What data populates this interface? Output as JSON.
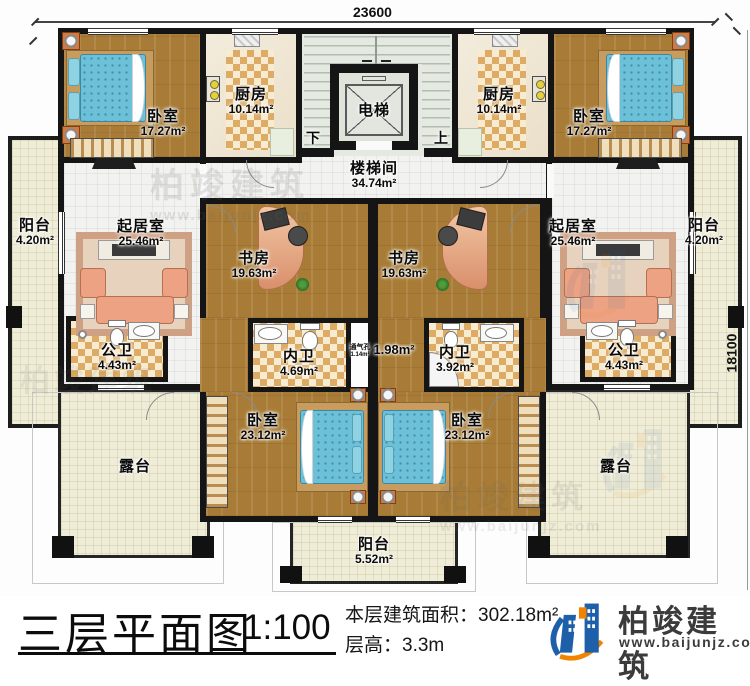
{
  "plan": {
    "dimensions": {
      "top": "23600",
      "right": "18100"
    },
    "rooms": {
      "bedroom_tl": {
        "name": "卧室",
        "area": "17.27m²"
      },
      "kitchen_l": {
        "name": "厨房",
        "area": "10.14m²"
      },
      "elevator": {
        "name": "电梯"
      },
      "stairwell": {
        "name": "楼梯间",
        "area": "34.74m²"
      },
      "stairs": {
        "down": "下",
        "up": "上"
      },
      "kitchen_r": {
        "name": "厨房",
        "area": "10.14m²"
      },
      "bedroom_tr": {
        "name": "卧室",
        "area": "17.27m²"
      },
      "balcony_l": {
        "name": "阳台",
        "area": "4.20m²"
      },
      "living_l": {
        "name": "起居室",
        "area": "25.46m²"
      },
      "living_r": {
        "name": "起居室",
        "area": "25.46m²"
      },
      "balcony_r": {
        "name": "阳台",
        "area": "4.20m²"
      },
      "study_l": {
        "name": "书房",
        "area": "19.63m²"
      },
      "study_r": {
        "name": "书房",
        "area": "19.63m²"
      },
      "bath_public_l": {
        "name": "公卫",
        "area": "4.43m²"
      },
      "bath_public_r": {
        "name": "公卫",
        "area": "4.43m²"
      },
      "bath_inner_l": {
        "name": "内卫",
        "area": "4.69m²"
      },
      "bath_inner_r": {
        "name": "内卫",
        "area": "3.92m²"
      },
      "vent": {
        "name": "通气孔",
        "area": "1.14m²"
      },
      "hall_area": {
        "area": "1.98m²"
      },
      "bedroom_bl": {
        "name": "卧室",
        "area": "23.12m²"
      },
      "bedroom_br": {
        "name": "卧室",
        "area": "23.12m²"
      },
      "terrace_l": {
        "name": "露台"
      },
      "terrace_r": {
        "name": "露台"
      },
      "balcony_b": {
        "name": "阳台",
        "area": "5.52m²"
      }
    },
    "watermark": {
      "name": "柏竣建筑",
      "url": "www.baijunjz.com"
    }
  },
  "titlebar": {
    "title": "三层平面图",
    "scale": "1:100",
    "area_note": "本层建筑面积：302.18m²",
    "height_note": "层高：3.3m"
  },
  "logo": {
    "name": "柏竣建筑",
    "url": "www.baijunjz.com"
  },
  "colors": {
    "wall": "#151515",
    "wood_floor": "#a87c36",
    "checker_tile": "#ddab64",
    "bed_blue": "#6cc0d8",
    "balcony_tile": "#efecd7",
    "logo_blue": "#1d5fa8",
    "logo_orange": "#f08300"
  }
}
